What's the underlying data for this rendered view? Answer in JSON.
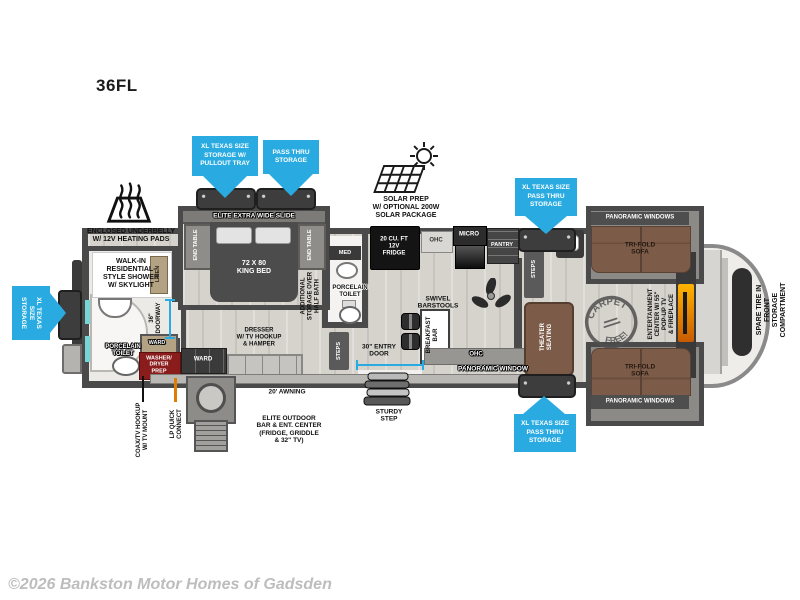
{
  "meta": {
    "model": "36FL",
    "copyright": "©2026 Bankston Motor Homes of Gadsden"
  },
  "colors": {
    "callout_arrow": "#29abe2",
    "wall": "#4a4a4a",
    "sofa_brown": "#7c5c48",
    "washer_prep_red": "#8a1c1c",
    "fireplace_orange": "#ff9000"
  },
  "callouts": {
    "pullout_tray": "XL TEXAS SIZE\nSTORAGE W/\nPULLOUT TRAY",
    "pass_thru": "PASS THRU\nSTORAGE",
    "xl_pass_thru_top": "XL TEXAS SIZE\nPASS THRU\nSTORAGE",
    "xl_pass_thru_bottom": "XL TEXAS SIZE\nPASS THRU\nSTORAGE",
    "xl_storage_rear": "XL TEXAS SIZE\nSTORAGE"
  },
  "exterior": {
    "underbelly": "ENCLOSED UNDERBELLY\nW/ 12V HEATING PADS",
    "solar": "SOLAR PREP\nW/ OPTIONAL 200W\nSOLAR PACKAGE",
    "awning": "20' AWNING",
    "sturdy_step": "STURDY\nSTEP",
    "coax": "COAX/TV HOOKUP\nW/ TV MOUNT",
    "lp": "LP QUICK\nCONNECT",
    "outdoor_bar": "ELITE OUTDOOR\nBAR & ENT. CENTER\n(FRIDGE, GRIDDLE\n& 32\" TV)",
    "spare_tire": "SPARE TIRE IN FRONT\nSTORAGE COMPARTMENT"
  },
  "bedroom": {
    "slide": "ELITE EXTRA WIDE SLIDE",
    "end_table": "END TABLE",
    "bed": "72 X 80\nKING BED",
    "dresser": "DRESSER\nW/ TV HOOKUP\n& HAMPER",
    "ward": "WARD",
    "washer": "WASHER/\nDRYER\nPREP",
    "doorway": "36\"\nDOORWAY"
  },
  "rear_bath": {
    "shower": "WALK-IN\nRESIDENTIAL-\nSTYLE SHOWER\nW/ SKYLIGHT",
    "toilet": "PORCELAIN\nTOILET",
    "linen": "LINEN"
  },
  "half_bath": {
    "med": "MED",
    "toilet": "PORCELAIN\nTOILET",
    "storage_over": "ADDITIONAL\nSTORAGE OVER\nHALF BATH",
    "steps": "STEPS",
    "entry_door": "30\" ENTRY\nDOOR"
  },
  "kitchen": {
    "fridge": "20 CU. FT\n12V\nFRIDGE",
    "ohc": "OHC",
    "micro": "MICRO",
    "pantry": "PANTRY",
    "breakfast_bar": "BREAKFAST\nBAR",
    "stools": "SWIVEL\nBARSTOOLS"
  },
  "living": {
    "ohc": "OHC",
    "window": "PANORAMIC WINDOW",
    "steps": "STEPS",
    "theater": "THEATER\nSEATING",
    "stamp_top": "CARPET",
    "stamp_bottom": "FREE!",
    "sofa": "TRI-FOLD\nSOFA",
    "windows": "PANORAMIC WINDOWS",
    "entertainment": "ENTERTAINMENT\nCENTER W/ 55\"\nPOP-UP TV\n& FIREPLACE"
  }
}
